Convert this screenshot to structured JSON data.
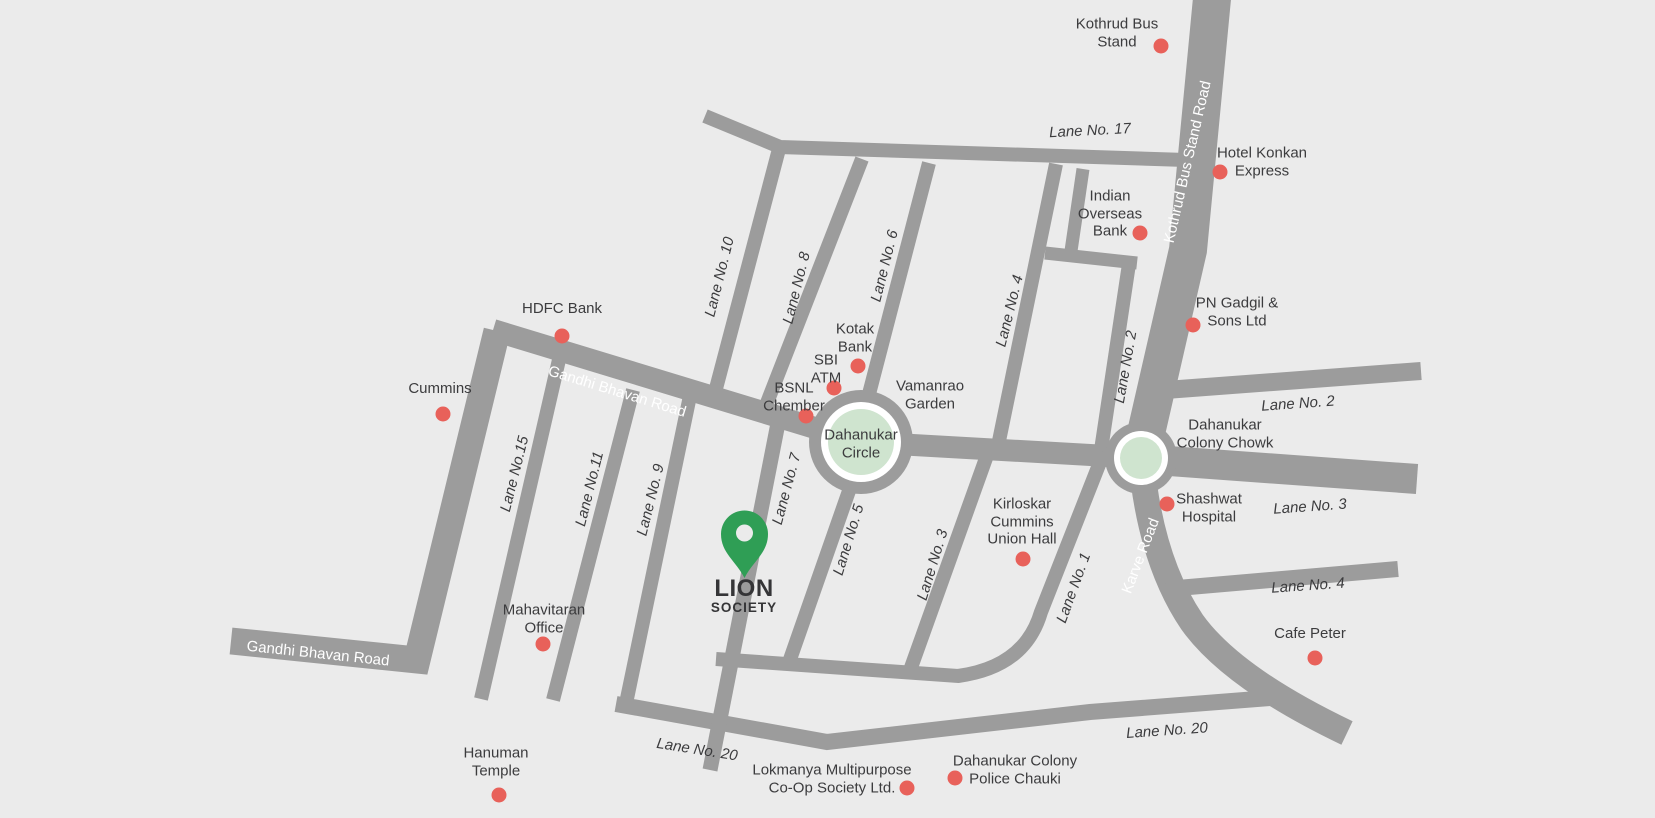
{
  "map": {
    "society": {
      "name": "LION",
      "type": "SOCIETY"
    },
    "roads": {
      "gandhi_bhavan_road": "Gandhi Bhavan Road",
      "kothrud_bus_stand_road": "Kothrud Bus Stand Road",
      "karve_road": "Karve Road"
    },
    "roundabouts": {
      "dahanukar_circle": "Dahanukar\nCircle",
      "dahanukar_colony_chowk": "Dahanukar\nColony Chowk"
    },
    "lanes": {
      "lane_1": "Lane No. 1",
      "lane_2": "Lane No. 2",
      "lane_3": "Lane No. 3",
      "lane_4": "Lane No. 4",
      "lane_5": "Lane No. 5",
      "lane_6": "Lane No. 6",
      "lane_7": "Lane No. 7",
      "lane_8": "Lane No. 8",
      "lane_9": "Lane No. 9",
      "lane_10": "Lane No. 10",
      "lane_11": "Lane No.11",
      "lane_15": "Lane No.15",
      "lane_17": "Lane No. 17",
      "lane_20": "Lane No. 20"
    },
    "landmarks": {
      "kothrud_bus_stand": "Kothrud Bus\nStand",
      "hotel_konkan_express": "Hotel Konkan\nExpress",
      "indian_overseas_bank": "Indian\nOverseas\nBank",
      "pn_gadgil_sons": "PN Gadgil &\nSons Ltd",
      "hdfc_bank": "HDFC Bank",
      "cummins": "Cummins",
      "kotak_bank": "Kotak\nBank",
      "sbi_atm": "SBI\nATM",
      "bsnl_chember": "BSNL\nChember",
      "vamanrao_garden": "Vamanrao\nGarden",
      "shashwat_hospital": "Shashwat\nHospital",
      "kirloskar_cummins_union_hall": "Kirloskar\nCummins\nUnion Hall",
      "cafe_peter": "Cafe Peter",
      "mahavitaran_office": "Mahavitaran\nOffice",
      "hanuman_temple": "Hanuman\nTemple",
      "lokmanya_society": "Lokmanya Multipurpose\nCo-Op Society Ltd.",
      "dahanukar_police_chauki": "Dahanukar Colony\nPolice Chauki"
    },
    "colors": {
      "background": "#ebebeb",
      "road": "#9c9c9c",
      "marker": "#e8615a",
      "pin": "#2f9e55",
      "roundabout": "#cfe4cf",
      "text": "#3c3c3e"
    }
  }
}
